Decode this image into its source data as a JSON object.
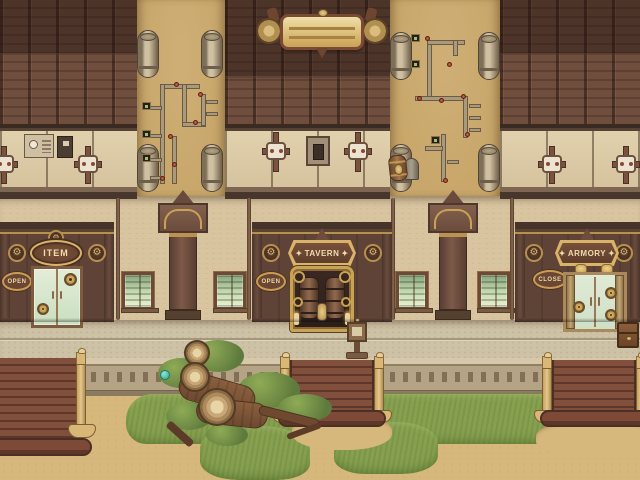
{
  "scene": {
    "description": "Top-down steampunk town shopping street",
    "palette": {
      "roof_brown": "#6f4e3d",
      "roof_dark": "#4a342a",
      "alley_sand": "#c9a76b",
      "wall_beige": "#d8c5a0",
      "facade_brown": "#5f4337",
      "brass_gold": "#c9a254",
      "sign_text": "#f0ddae",
      "door_glass_green": "#d7e6cd",
      "walkway_stone": "#cec2a6",
      "grass_green": "#87a050",
      "ground_sand": "#d6b87c",
      "valve_red": "#b5472f"
    }
  },
  "banner": {
    "label": ""
  },
  "shops": [
    {
      "id": "item-shop",
      "sign_label": "ITEM",
      "ornament": "",
      "status_label": "OPEN"
    },
    {
      "id": "tavern",
      "sign_label": "TAVERN",
      "ornament": "✦",
      "status_label": "OPEN"
    },
    {
      "id": "armory",
      "sign_label": "ARMORY",
      "ornament": "✦",
      "status_label": "CLOSE"
    }
  ],
  "icons": {
    "gear": "⚙"
  }
}
